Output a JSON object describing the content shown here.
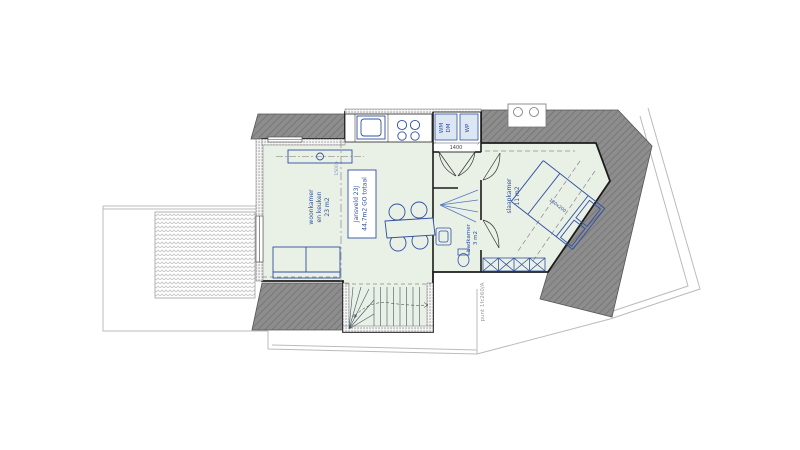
{
  "floor_plan": {
    "unit": {
      "name": "Jansveld 23J",
      "area": "44,7m2 GO totaal"
    },
    "rooms": {
      "living": {
        "line1": "woonkamer",
        "line2": "en keuken",
        "area": "23 m2"
      },
      "bedroom": {
        "name": "slaapkamer",
        "area": "11 m2"
      },
      "bathroom": {
        "name": "badkamer",
        "area": "3 m2"
      }
    },
    "appliances": {
      "wm": "WM",
      "dm": "DM",
      "wp": "WP"
    },
    "dimension_label": "1400",
    "bed_dimension": "180x200",
    "height_line_label": "1500+",
    "reference_label": "punt 1fc260/A",
    "colors": {
      "roof_gray": "#8d8d8d",
      "interior_green": "#e9f0e6",
      "accent_blue": "#3050a0",
      "wall_black": "#1c1c1c",
      "outline_gray": "#bbbbbb"
    }
  }
}
